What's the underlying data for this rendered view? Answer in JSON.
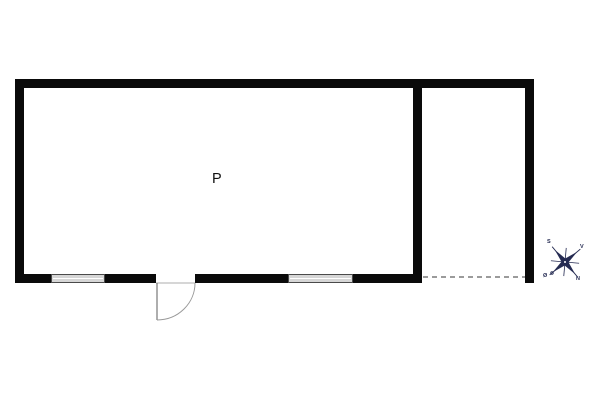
{
  "room": {
    "label": "P"
  },
  "compass": {
    "north_label": "N",
    "south_label": "S",
    "east_label": "Ø",
    "west_label": "V"
  },
  "colors": {
    "background": "#ffffff",
    "wall": "#0a0a0a",
    "window_fill": "#d6d6d6",
    "window_border": "#4a4a4a",
    "door_leaf": "#777777",
    "door_arc": "#999999",
    "door_threshold": "#bdbdbd",
    "dashed_boundary": "#9b9b9b",
    "compass": "#252b52",
    "label_text": "#111111"
  }
}
